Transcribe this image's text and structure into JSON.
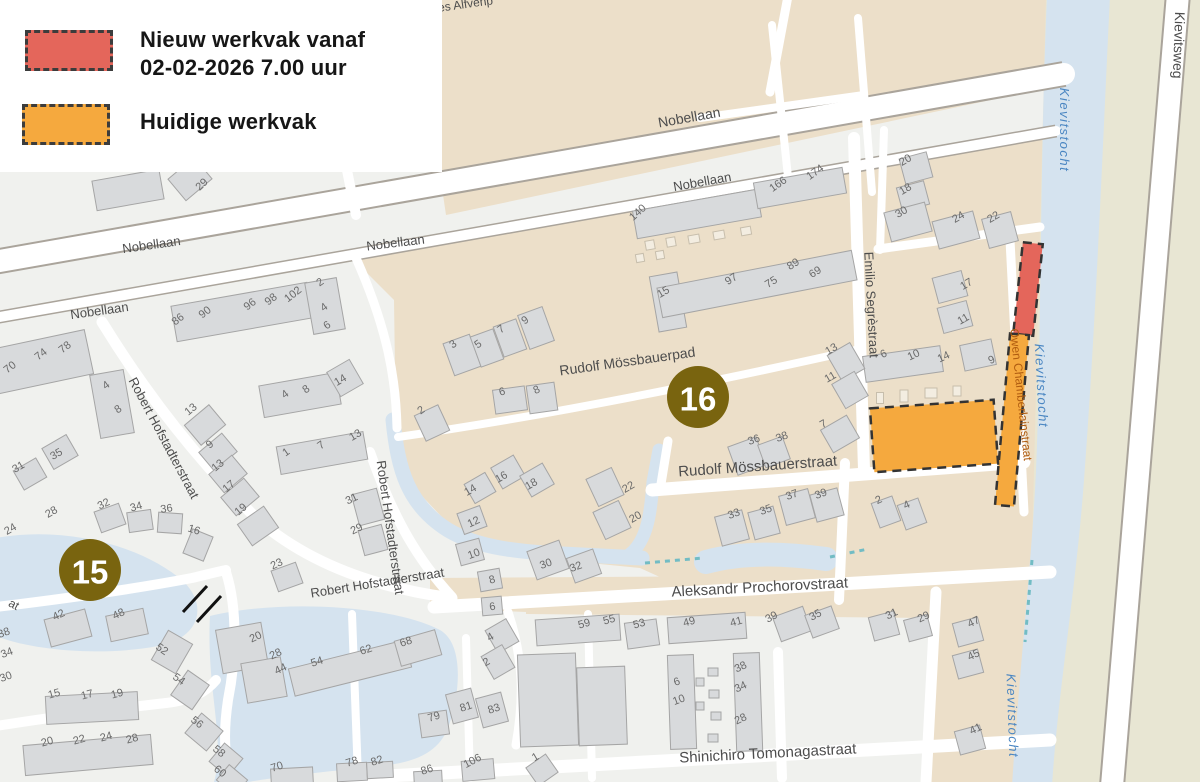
{
  "legend": {
    "new_work": {
      "line1": "Nieuw werkvak vanaf",
      "line2": "02-02-2026 7.00 uur"
    },
    "current_work": {
      "label": "Huidige werkvak"
    }
  },
  "markers": [
    {
      "number": "15",
      "x": 90,
      "y": 570
    },
    {
      "number": "16",
      "x": 698,
      "y": 397
    }
  ],
  "streets": [
    {
      "t": "Nobellaan",
      "x": 690,
      "y": 122,
      "r": -10,
      "s": 14,
      "k": "road"
    },
    {
      "t": "Nobellaan",
      "x": 703,
      "y": 186,
      "r": -10,
      "s": 13,
      "k": "road"
    },
    {
      "t": "Nobellaan",
      "x": 396,
      "y": 247,
      "r": -7,
      "s": 13,
      "k": "road"
    },
    {
      "t": "Nobellaan",
      "x": 152,
      "y": 249,
      "r": -8,
      "s": 13,
      "k": "road"
    },
    {
      "t": "Nobellaan",
      "x": 100,
      "y": 315,
      "r": -8,
      "s": 13,
      "k": "road"
    },
    {
      "t": "Rudolf Mössbauerpad",
      "x": 628,
      "y": 366,
      "r": -8,
      "s": 14,
      "k": "road"
    },
    {
      "t": "Rudolf Mössbauerstraat",
      "x": 758,
      "y": 471,
      "r": -4,
      "s": 15,
      "k": "road"
    },
    {
      "t": "Aleksandr Prochorovstraat",
      "x": 760,
      "y": 592,
      "r": -3,
      "s": 15,
      "k": "road"
    },
    {
      "t": "Shinichiro Tomonagastraat",
      "x": 768,
      "y": 758,
      "r": -3,
      "s": 15,
      "k": "road"
    },
    {
      "t": "Robert Hofstadterstraat",
      "x": 160,
      "y": 440,
      "r": 62,
      "s": 13,
      "k": "road"
    },
    {
      "t": "Robert Hofstadterstraat",
      "x": 386,
      "y": 528,
      "r": 82,
      "s": 13,
      "k": "road"
    },
    {
      "t": "Robert Hofstadterstraat",
      "x": 378,
      "y": 587,
      "r": -9,
      "s": 13,
      "k": "road"
    },
    {
      "t": "Emilio Segrèstraat",
      "x": 867,
      "y": 305,
      "r": 87,
      "s": 13,
      "k": "road"
    },
    {
      "t": "Owen Chamberlainstraat",
      "x": 1017,
      "y": 395,
      "r": 84,
      "s": 12,
      "k": "owen"
    },
    {
      "t": "Kievitsweg",
      "x": 1174,
      "y": 45,
      "r": 92,
      "s": 14,
      "k": "road"
    },
    {
      "t": "Kievitstocht",
      "x": 1060,
      "y": 130,
      "r": 90,
      "s": 13,
      "k": "water"
    },
    {
      "t": "Kievitstocht",
      "x": 1037,
      "y": 386,
      "r": 87,
      "s": 13,
      "k": "water"
    },
    {
      "t": "Kievitstocht",
      "x": 1008,
      "y": 716,
      "r": 88,
      "s": 13,
      "k": "water"
    },
    {
      "t": "es Alfvénp",
      "x": 466,
      "y": 8,
      "r": -8,
      "s": 12,
      "k": "road"
    },
    {
      "t": "at",
      "x": 12,
      "y": 608,
      "r": 28,
      "s": 12,
      "k": "road"
    }
  ],
  "house_numbers": [
    {
      "n": "29",
      "x": 204,
      "y": 187,
      "r": -42
    },
    {
      "n": "86",
      "x": 180,
      "y": 322,
      "r": -38
    },
    {
      "n": "90",
      "x": 207,
      "y": 315,
      "r": -38
    },
    {
      "n": "96",
      "x": 252,
      "y": 307,
      "r": -38
    },
    {
      "n": "98",
      "x": 273,
      "y": 302,
      "r": -38
    },
    {
      "n": "102",
      "x": 295,
      "y": 297,
      "r": -38
    },
    {
      "n": "2",
      "x": 322,
      "y": 285,
      "r": -35
    },
    {
      "n": "4",
      "x": 326,
      "y": 310,
      "r": -35
    },
    {
      "n": "6",
      "x": 329,
      "y": 328,
      "r": -35
    },
    {
      "n": "70",
      "x": 12,
      "y": 370,
      "r": -38
    },
    {
      "n": "74",
      "x": 43,
      "y": 357,
      "r": -38
    },
    {
      "n": "78",
      "x": 67,
      "y": 350,
      "r": -38
    },
    {
      "n": "4",
      "x": 108,
      "y": 388,
      "r": -35
    },
    {
      "n": "8",
      "x": 120,
      "y": 412,
      "r": -35
    },
    {
      "n": "35",
      "x": 58,
      "y": 457,
      "r": -30
    },
    {
      "n": "31",
      "x": 20,
      "y": 470,
      "r": -30
    },
    {
      "n": "13",
      "x": 193,
      "y": 412,
      "r": -40
    },
    {
      "n": "9",
      "x": 212,
      "y": 447,
      "r": -40
    },
    {
      "n": "13",
      "x": 220,
      "y": 468,
      "r": -40
    },
    {
      "n": "17",
      "x": 231,
      "y": 489,
      "r": -40
    },
    {
      "n": "19",
      "x": 243,
      "y": 512,
      "r": -40
    },
    {
      "n": "14",
      "x": 342,
      "y": 383,
      "r": -30
    },
    {
      "n": "4",
      "x": 287,
      "y": 397,
      "r": -35
    },
    {
      "n": "8",
      "x": 308,
      "y": 392,
      "r": -35
    },
    {
      "n": "13",
      "x": 357,
      "y": 438,
      "r": -30
    },
    {
      "n": "1",
      "x": 288,
      "y": 455,
      "r": -35
    },
    {
      "n": "7",
      "x": 323,
      "y": 448,
      "r": -35
    },
    {
      "n": "31",
      "x": 353,
      "y": 502,
      "r": -25
    },
    {
      "n": "29",
      "x": 358,
      "y": 532,
      "r": -25
    },
    {
      "n": "23",
      "x": 278,
      "y": 567,
      "r": -25
    },
    {
      "n": "32",
      "x": 105,
      "y": 507,
      "r": -25
    },
    {
      "n": "34",
      "x": 137,
      "y": 510,
      "r": -15
    },
    {
      "n": "36",
      "x": 167,
      "y": 512,
      "r": -8
    },
    {
      "n": "16",
      "x": 193,
      "y": 533,
      "r": 18
    },
    {
      "n": "28",
      "x": 53,
      "y": 515,
      "r": -30
    },
    {
      "n": "24",
      "x": 12,
      "y": 532,
      "r": -30
    },
    {
      "n": "42",
      "x": 60,
      "y": 618,
      "r": -25
    },
    {
      "n": "48",
      "x": 120,
      "y": 617,
      "r": -25
    },
    {
      "n": "52",
      "x": 160,
      "y": 652,
      "r": 35
    },
    {
      "n": "54",
      "x": 177,
      "y": 682,
      "r": 35
    },
    {
      "n": "38",
      "x": 5,
      "y": 636,
      "r": -20
    },
    {
      "n": "34",
      "x": 8,
      "y": 656,
      "r": -20
    },
    {
      "n": "30",
      "x": 7,
      "y": 680,
      "r": -20
    },
    {
      "n": "15",
      "x": 55,
      "y": 697,
      "r": -15
    },
    {
      "n": "17",
      "x": 88,
      "y": 698,
      "r": -15
    },
    {
      "n": "19",
      "x": 118,
      "y": 697,
      "r": -15
    },
    {
      "n": "20",
      "x": 48,
      "y": 745,
      "r": -15
    },
    {
      "n": "22",
      "x": 80,
      "y": 743,
      "r": -15
    },
    {
      "n": "24",
      "x": 107,
      "y": 740,
      "r": -15
    },
    {
      "n": "28",
      "x": 133,
      "y": 742,
      "r": -15
    },
    {
      "n": "56",
      "x": 195,
      "y": 725,
      "r": 38
    },
    {
      "n": "58",
      "x": 217,
      "y": 754,
      "r": 38
    },
    {
      "n": "60",
      "x": 218,
      "y": 774,
      "r": 38
    },
    {
      "n": "3",
      "x": 455,
      "y": 347,
      "r": -35
    },
    {
      "n": "5",
      "x": 480,
      "y": 347,
      "r": -35
    },
    {
      "n": "7",
      "x": 503,
      "y": 332,
      "r": -35
    },
    {
      "n": "9",
      "x": 527,
      "y": 323,
      "r": -35
    },
    {
      "n": "15",
      "x": 665,
      "y": 295,
      "r": -30
    },
    {
      "n": "2",
      "x": 423,
      "y": 413,
      "r": -35
    },
    {
      "n": "6",
      "x": 503,
      "y": 395,
      "r": -15
    },
    {
      "n": "8",
      "x": 538,
      "y": 393,
      "r": -25
    },
    {
      "n": "140",
      "x": 640,
      "y": 215,
      "r": -42
    },
    {
      "n": "166",
      "x": 780,
      "y": 187,
      "r": -35
    },
    {
      "n": "174",
      "x": 817,
      "y": 175,
      "r": -35
    },
    {
      "n": "97",
      "x": 733,
      "y": 282,
      "r": -32
    },
    {
      "n": "75",
      "x": 773,
      "y": 285,
      "r": -32
    },
    {
      "n": "89",
      "x": 795,
      "y": 267,
      "r": -32
    },
    {
      "n": "69",
      "x": 817,
      "y": 275,
      "r": -32
    },
    {
      "n": "20",
      "x": 907,
      "y": 163,
      "r": -30
    },
    {
      "n": "18",
      "x": 907,
      "y": 192,
      "r": -30
    },
    {
      "n": "30",
      "x": 903,
      "y": 215,
      "r": -30
    },
    {
      "n": "24",
      "x": 960,
      "y": 220,
      "r": -30
    },
    {
      "n": "22",
      "x": 995,
      "y": 220,
      "r": -30
    },
    {
      "n": "17",
      "x": 968,
      "y": 287,
      "r": -30
    },
    {
      "n": "11",
      "x": 965,
      "y": 322,
      "r": -30
    },
    {
      "n": "6",
      "x": 885,
      "y": 357,
      "r": -25
    },
    {
      "n": "10",
      "x": 915,
      "y": 358,
      "r": -25
    },
    {
      "n": "14",
      "x": 945,
      "y": 360,
      "r": -25
    },
    {
      "n": "9",
      "x": 993,
      "y": 363,
      "r": -25
    },
    {
      "n": "13",
      "x": 833,
      "y": 352,
      "r": -30
    },
    {
      "n": "11",
      "x": 832,
      "y": 380,
      "r": -30
    },
    {
      "n": "7",
      "x": 825,
      "y": 427,
      "r": -30
    },
    {
      "n": "2",
      "x": 880,
      "y": 503,
      "r": -25
    },
    {
      "n": "4",
      "x": 908,
      "y": 508,
      "r": -25
    },
    {
      "n": "16",
      "x": 503,
      "y": 480,
      "r": -30
    },
    {
      "n": "18",
      "x": 533,
      "y": 487,
      "r": -30
    },
    {
      "n": "14",
      "x": 472,
      "y": 493,
      "r": -30
    },
    {
      "n": "12",
      "x": 475,
      "y": 525,
      "r": -25
    },
    {
      "n": "10",
      "x": 475,
      "y": 557,
      "r": -20
    },
    {
      "n": "8",
      "x": 493,
      "y": 583,
      "r": -15
    },
    {
      "n": "6",
      "x": 493,
      "y": 610,
      "r": -10
    },
    {
      "n": "22",
      "x": 630,
      "y": 490,
      "r": -30
    },
    {
      "n": "20",
      "x": 637,
      "y": 520,
      "r": -30
    },
    {
      "n": "30",
      "x": 547,
      "y": 567,
      "r": -20
    },
    {
      "n": "32",
      "x": 577,
      "y": 570,
      "r": -20
    },
    {
      "n": "36",
      "x": 755,
      "y": 443,
      "r": -20
    },
    {
      "n": "38",
      "x": 783,
      "y": 440,
      "r": -20
    },
    {
      "n": "33",
      "x": 735,
      "y": 517,
      "r": -20
    },
    {
      "n": "35",
      "x": 767,
      "y": 513,
      "r": -20
    },
    {
      "n": "37",
      "x": 793,
      "y": 498,
      "r": -20
    },
    {
      "n": "39",
      "x": 822,
      "y": 497,
      "r": -20
    },
    {
      "n": "4",
      "x": 492,
      "y": 640,
      "r": -30
    },
    {
      "n": "2",
      "x": 488,
      "y": 665,
      "r": -30
    },
    {
      "n": "79",
      "x": 435,
      "y": 720,
      "r": -18
    },
    {
      "n": "81",
      "x": 467,
      "y": 710,
      "r": -18
    },
    {
      "n": "83",
      "x": 495,
      "y": 712,
      "r": -18
    },
    {
      "n": "59",
      "x": 585,
      "y": 627,
      "r": -15
    },
    {
      "n": "55",
      "x": 610,
      "y": 623,
      "r": -15
    },
    {
      "n": "53",
      "x": 640,
      "y": 627,
      "r": -15
    },
    {
      "n": "49",
      "x": 690,
      "y": 625,
      "r": -15
    },
    {
      "n": "41",
      "x": 737,
      "y": 625,
      "r": -15
    },
    {
      "n": "39",
      "x": 773,
      "y": 620,
      "r": -28
    },
    {
      "n": "35",
      "x": 817,
      "y": 618,
      "r": -28
    },
    {
      "n": "6",
      "x": 678,
      "y": 685,
      "r": -20
    },
    {
      "n": "10",
      "x": 680,
      "y": 703,
      "r": -20
    },
    {
      "n": "38",
      "x": 742,
      "y": 670,
      "r": -25
    },
    {
      "n": "34",
      "x": 742,
      "y": 690,
      "r": -25
    },
    {
      "n": "28",
      "x": 742,
      "y": 722,
      "r": -25
    },
    {
      "n": "20",
      "x": 257,
      "y": 640,
      "r": -25
    },
    {
      "n": "28",
      "x": 277,
      "y": 657,
      "r": -25
    },
    {
      "n": "44",
      "x": 282,
      "y": 672,
      "r": -25
    },
    {
      "n": "54",
      "x": 318,
      "y": 665,
      "r": -18
    },
    {
      "n": "62",
      "x": 367,
      "y": 653,
      "r": -18
    },
    {
      "n": "68",
      "x": 407,
      "y": 645,
      "r": -18
    },
    {
      "n": "70",
      "x": 278,
      "y": 770,
      "r": -18
    },
    {
      "n": "78",
      "x": 353,
      "y": 765,
      "r": -18
    },
    {
      "n": "82",
      "x": 378,
      "y": 764,
      "r": -18
    },
    {
      "n": "86",
      "x": 428,
      "y": 773,
      "r": -18
    },
    {
      "n": "106",
      "x": 474,
      "y": 764,
      "r": -28
    },
    {
      "n": "1",
      "x": 537,
      "y": 760,
      "r": -30
    },
    {
      "n": "31",
      "x": 893,
      "y": 617,
      "r": -25
    },
    {
      "n": "29",
      "x": 925,
      "y": 620,
      "r": -25
    },
    {
      "n": "47",
      "x": 975,
      "y": 625,
      "r": -25
    },
    {
      "n": "45",
      "x": 975,
      "y": 658,
      "r": -25
    },
    {
      "n": "41",
      "x": 977,
      "y": 732,
      "r": -25
    }
  ],
  "colors": {
    "construction_area": "#ecdfc9",
    "residential_area": "#f0f1ee",
    "water": "#d5e3ef",
    "greenway_area": "#e8e6d3",
    "building_fill": "#d8dadc",
    "building_stroke": "#a5a5a5",
    "shed_fill": "#f3ede1",
    "shed_stroke": "#c7beac",
    "road_fill": "#ffffff",
    "road_casing": "#aaa49b",
    "marker_fill": "#79640f",
    "marker_text": "#ffffff",
    "new_work_fill": "#e4665b",
    "current_work_fill": "#f5a93e",
    "work_border": "#333333",
    "street_label": "#4d4d4d",
    "house_number": "#6a6a6a",
    "water_label": "#4a86c2",
    "owen_label": "#b05c10",
    "culvert": "#72bcc4",
    "closure_mark": "#111111"
  }
}
